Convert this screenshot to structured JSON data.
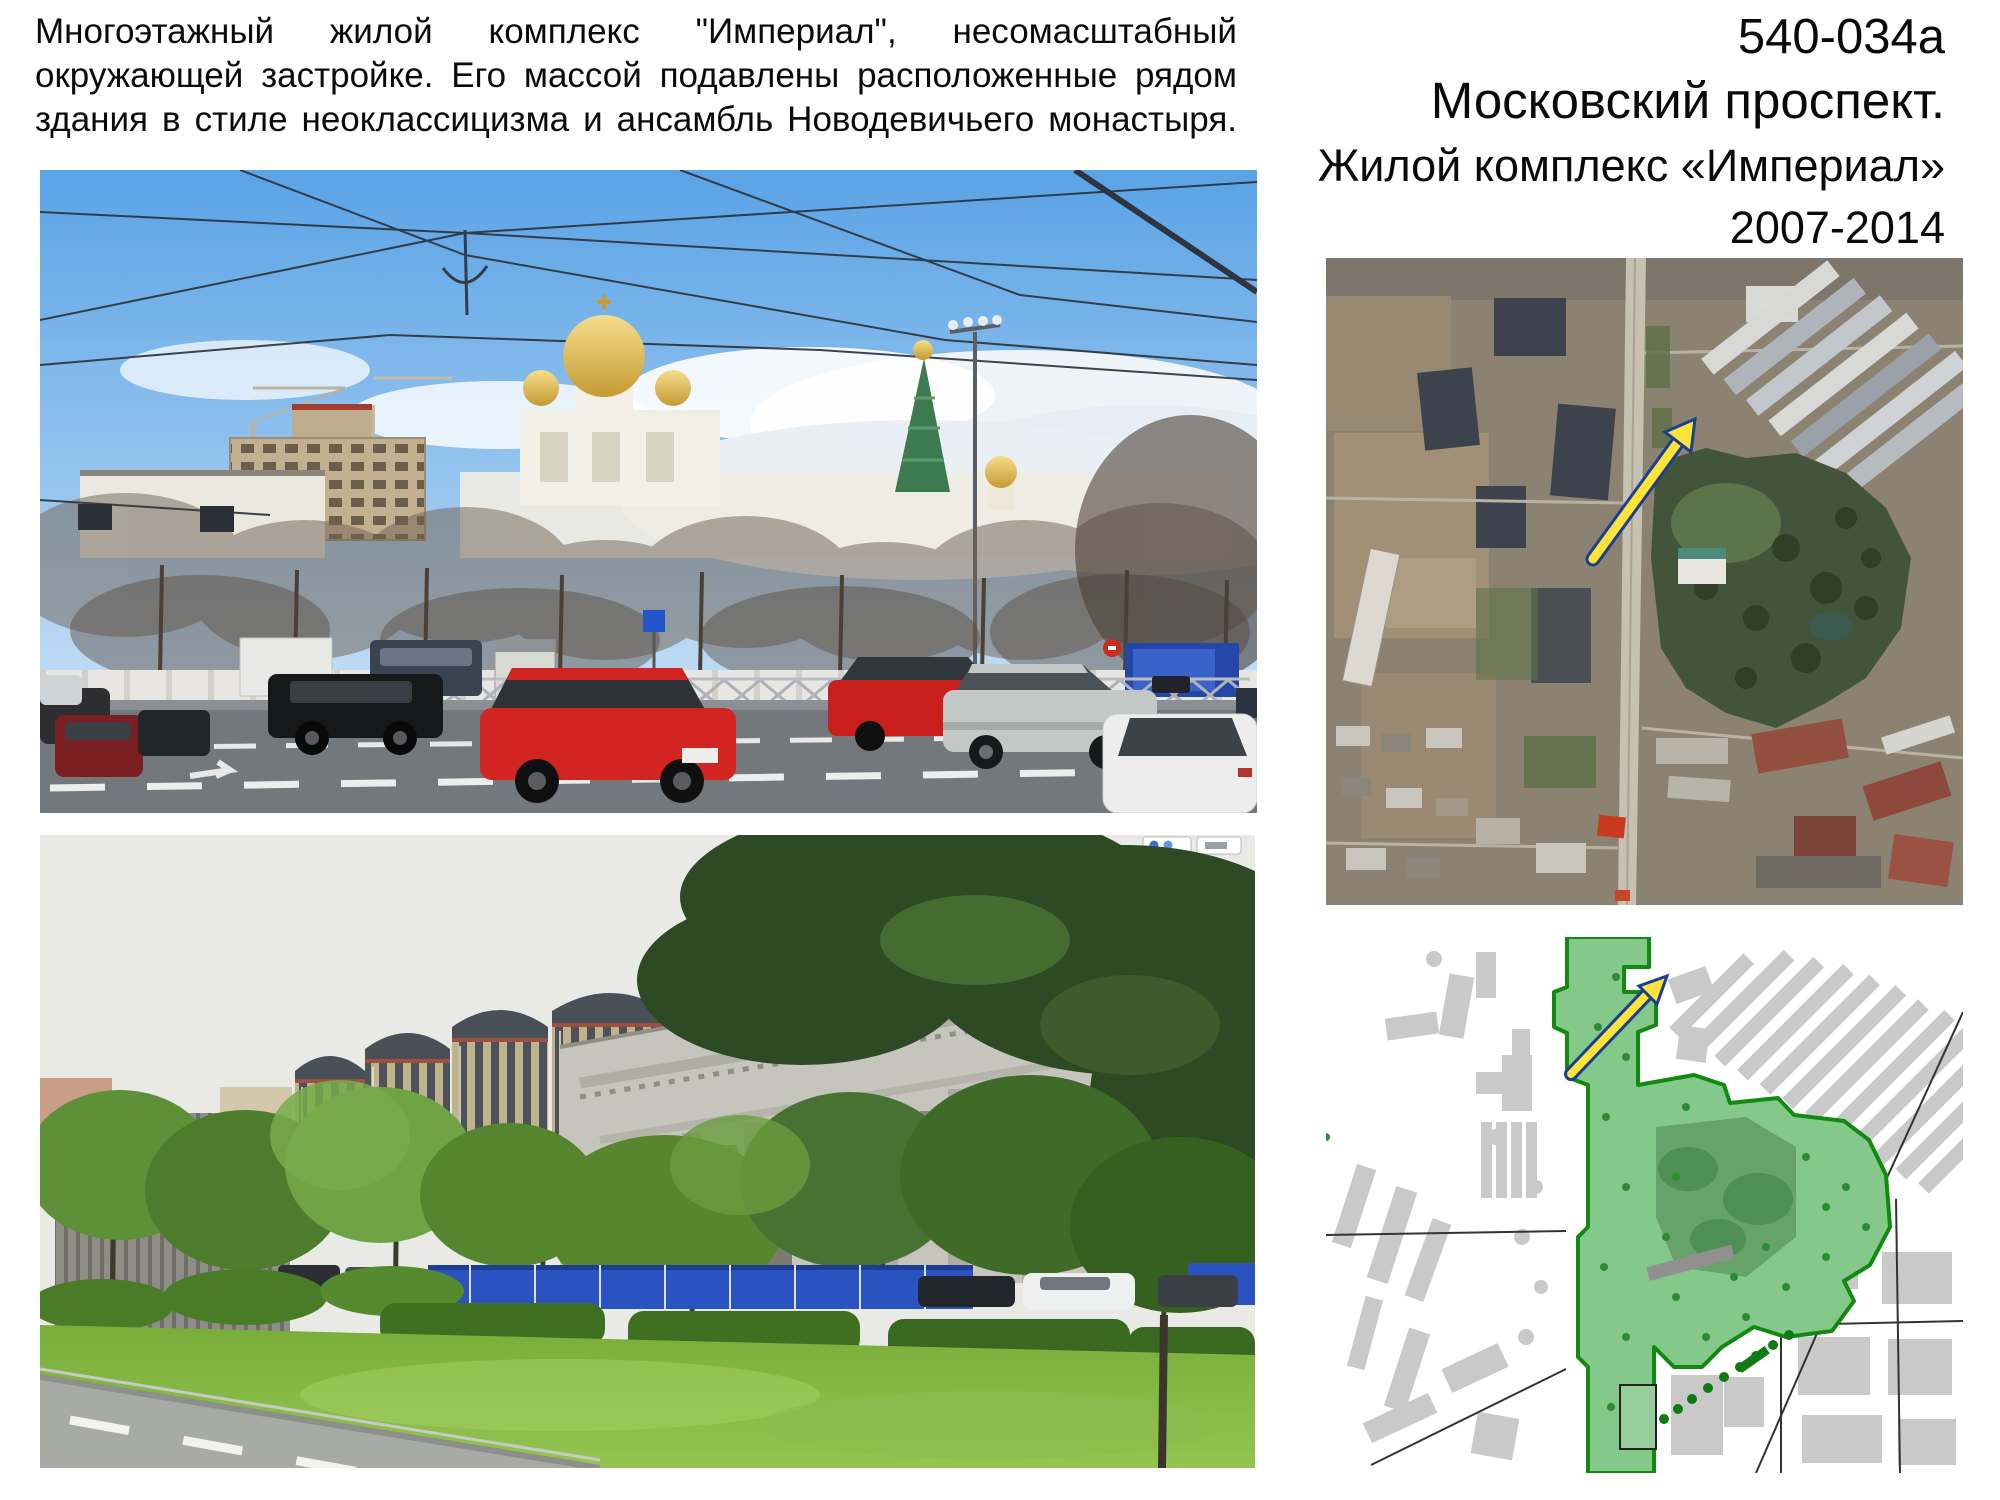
{
  "paragraph": {
    "lines": [
      "Многоэтажный жилой комплекс \"Империал\", несомасштабный",
      "окружающей застройке. Его массой подавлены расположенные рядом",
      "здания в стиле неоклассицизма и ансамбль Новодевичьего монастыря."
    ]
  },
  "title_block": {
    "code": "540-034a",
    "location": "Московский проспект.",
    "subject": "Жилой комплекс «Империал»",
    "years": "2007-2014"
  },
  "figures": {
    "photo_top": {
      "alt": "street-photo-moskovsky-prospekt-church-and-imperial-under-construction"
    },
    "photo_bottom": {
      "alt": "street-photo-imperial-towers-behind-neoclassical-building"
    },
    "satellite": {
      "alt": "aerial-photo-of-site-with-arrow"
    },
    "sitemap": {
      "alt": "schematic-city-map-with-green-zone-and-arrow"
    }
  },
  "colors": {
    "background": "#ffffff",
    "text": "#0a0a0a",
    "arrow_fill": "#ffe23a",
    "arrow_stroke": "#1b3f8f",
    "map_green_fill": "#85c98a",
    "map_green_stroke": "#128a12",
    "construction_fence_blue": "#2a52c0"
  }
}
